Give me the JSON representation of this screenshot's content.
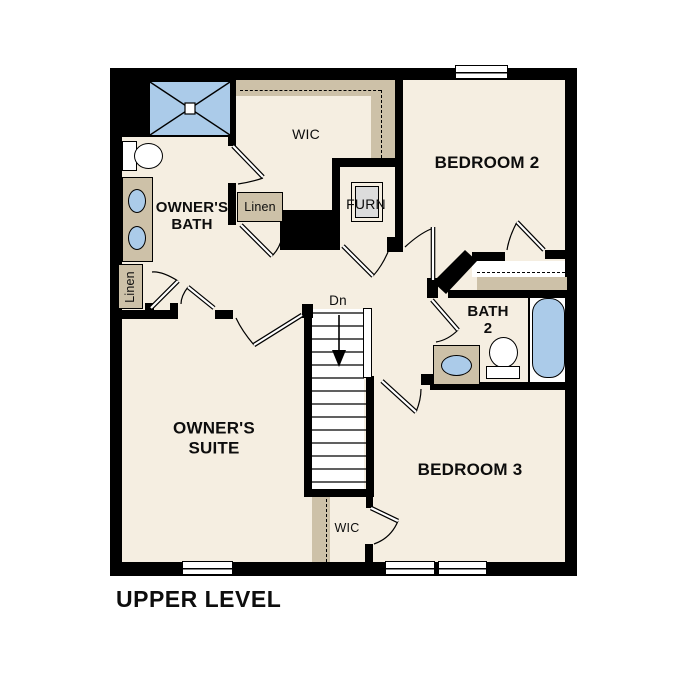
{
  "labels": {
    "title": "UPPER LEVEL",
    "owners_bath": "OWNER'S\nBATH",
    "wic_upper": "WIC",
    "bedroom2": "BEDROOM 2",
    "furnace": "FURN",
    "linen_mid": "Linen",
    "linen_left": "Linen",
    "bath2": "BATH\n2",
    "dn": "Dn",
    "owners_suite": "OWNER'S\nSUITE",
    "bedroom3": "BEDROOM 3",
    "wic_lower": "WIC"
  },
  "stairs": {
    "label": "Dn",
    "direction": "down",
    "treads": 14
  },
  "fixtures": {
    "owners_bath": [
      "shower",
      "toilet",
      "double-vanity-sink",
      "linen-closet"
    ],
    "bath2": [
      "vanity-sink",
      "toilet",
      "bathtub"
    ],
    "utility": [
      "furnace"
    ],
    "windows": 4
  },
  "colors": {
    "floor": "#F5EEE1",
    "wall": "#000000",
    "closet_shelf": "#CDC1A8",
    "fixture_blue": "#ABCBE9",
    "furnace_gray": "#DCDCDC",
    "background": "#FFFFFF"
  }
}
